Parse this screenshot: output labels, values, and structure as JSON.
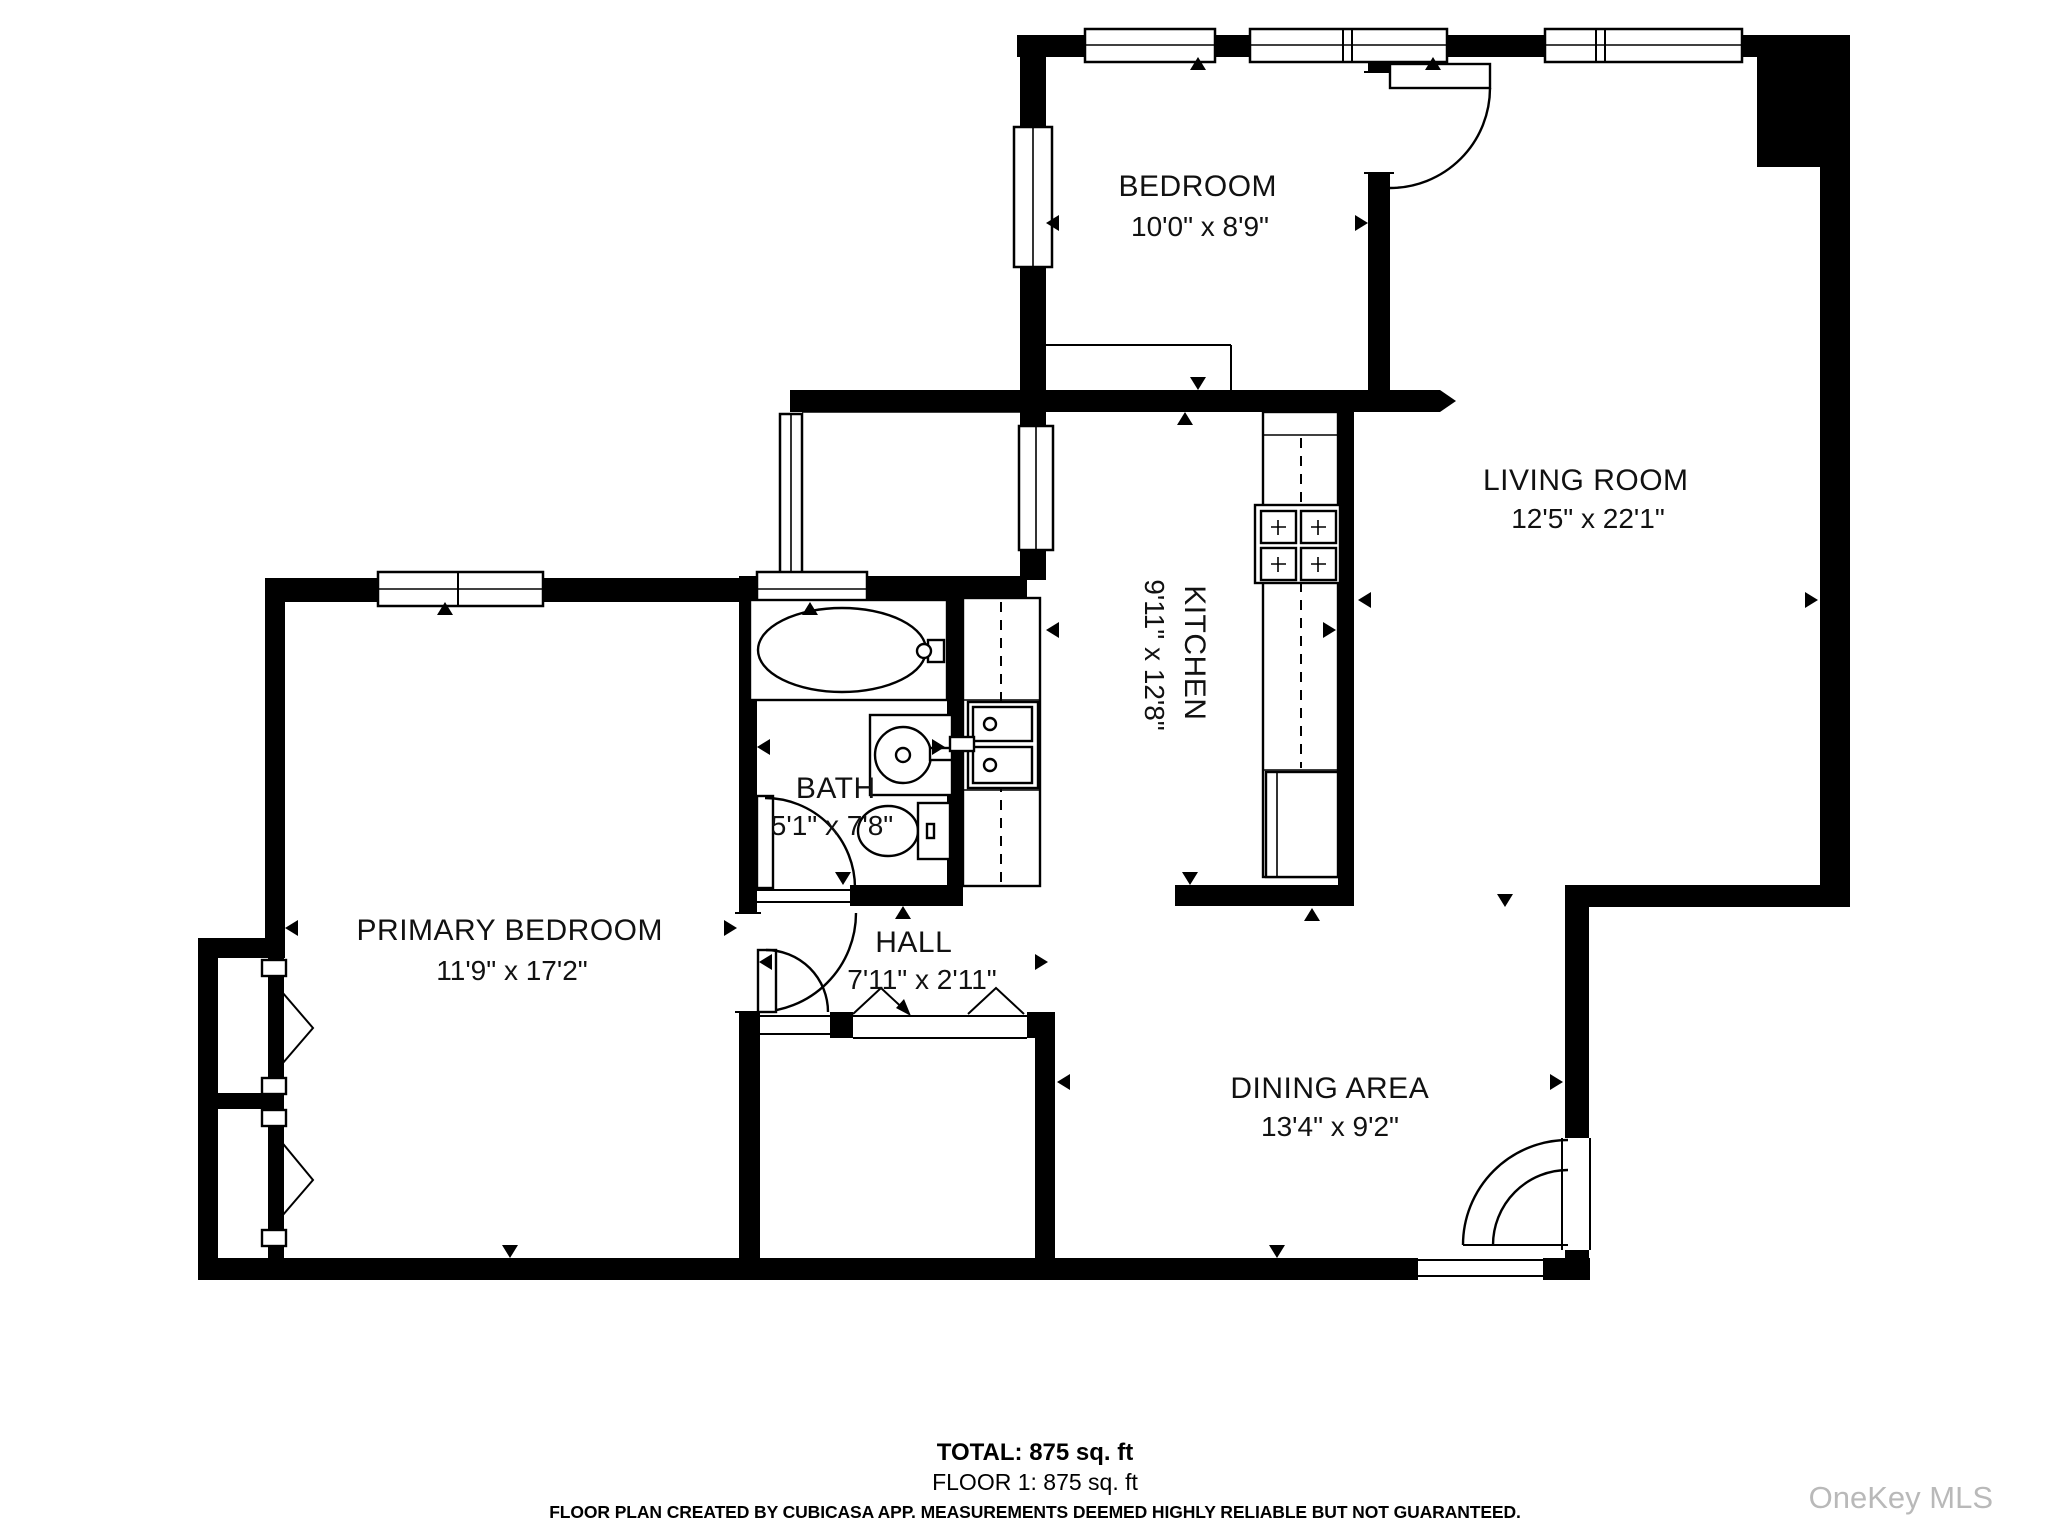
{
  "rooms": {
    "bedroom": {
      "name": "BEDROOM",
      "dims": "10'0\" x 8'9\""
    },
    "living_room": {
      "name": "LIVING ROOM",
      "dims": "12'5\" x 22'1\""
    },
    "kitchen": {
      "name": "KITCHEN",
      "dims": "9'11\" x 12'8\""
    },
    "bath": {
      "name": "BATH",
      "dims": "5'1\" x 7'8\""
    },
    "primary_bedroom": {
      "name": "PRIMARY BEDROOM",
      "dims": "11'9\" x 17'2\""
    },
    "hall": {
      "name": "HALL",
      "dims": "7'11\" x 2'11\""
    },
    "dining_area": {
      "name": "DINING AREA",
      "dims": "13'4\" x 9'2\""
    }
  },
  "summary": {
    "total": "TOTAL: 875 sq. ft",
    "floor_1": "FLOOR 1: 875 sq. ft"
  },
  "disclaimer": "FLOOR PLAN CREATED BY CUBICASA APP. MEASUREMENTS DEEMED HIGHLY RELIABLE BUT NOT GUARANTEED.",
  "watermark": "OneKey MLS",
  "colors": {
    "wall": "#000000",
    "background": "#ffffff",
    "watermark": "#b9b9b9"
  }
}
